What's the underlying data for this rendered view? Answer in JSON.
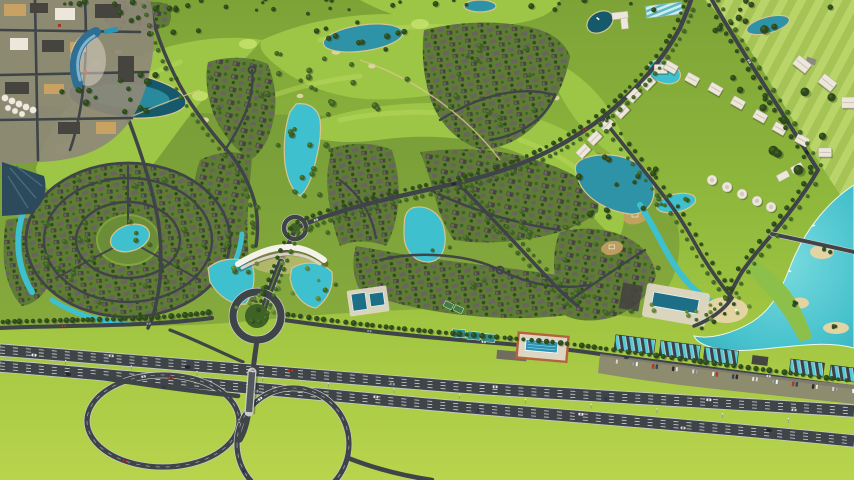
{
  "scene": {
    "type": "aerial-3d-masterplan-render",
    "description": "Bird's-eye 3D rendering of a golf-course residential master-planned community: golf fairways with lakes and sand bunkers, dense villa clusters along curved tree-lined streets, a circular villa village with a central lake, an entrance gateway with crescent water features, a hotel/town-centre district, diagonal rows of white apartment buildings, agricultural green fields, a crystal lagoon with sandy islands, a commercial strip with teal glass roofs, and a multi-lane highway with a cloverleaf interchange and roundabout in the foreground.",
    "width_px": 854,
    "height_px": 480,
    "visible_text": "none"
  },
  "labels": {
    "scene": "Aerial masterplan rendering of a golf community development",
    "terrain": "Grass terrain",
    "fields": "Agricultural fields with crop strips and scattered trees",
    "golf": "Golf course fairways with bunkers and greens",
    "lakes": "Lakes and ponds",
    "clusters": "Villa clusters with dark roofs along curved streets",
    "village": "Circular villa village with central lake and ring roads",
    "roads": "Community road network",
    "entrance": "Entrance gateway with white canopy and crescent pools",
    "hotel": "Hotel and town-centre district",
    "apartments": "Rows of white apartment buildings",
    "commercial": "Commercial strip with teal glass roofs and parking",
    "lagoon": "Crystal lagoon with sandy islands",
    "beach": "Beach club with lap pool and cabanas",
    "amenities": "Sports courts and swimming-pool complex",
    "highway": "Multi-lane highway with grass median",
    "interchange": "Cloverleaf interchange, overpass and roundabout",
    "vehicles": "Cars on roads and parking",
    "trees": "Trees and landscaping"
  },
  "palette": {
    "grassTop": "#7da337",
    "grassMid": "#92b93d",
    "grassBright": "#b5d24b",
    "communityTint": "#6b8d37",
    "field": "#a6c356",
    "fieldStrip": "#bcd76c",
    "fairway": "#9dc647",
    "fairwayStripe": "#bada5f",
    "golfGreen": "#c3e06a",
    "treeD": "#2d491d",
    "treeM": "#3f6326",
    "treeL": "#5c8430",
    "palmHi": "#7ba83e",
    "waterD": "#15596a",
    "waterM": "#2e93a6",
    "waterB": "#3fc0cf",
    "lagoonHi": "#7adde5",
    "waterEdge": "#d8c58f",
    "road": "#3f4448",
    "roadLight": "#c9ccc7",
    "lane": "#e9ebea",
    "sand": "#e3d4a4",
    "tan": "#c7a263",
    "parking": "#716c60",
    "roofD": "#46443f",
    "roofG": "#6a655c",
    "roofHi": "#8e887c",
    "clusterBg": "#5e7c33",
    "white": "#ece7da",
    "whiteShade": "#b9b1a0",
    "glass": "#2f6f94",
    "glassHi": "#7fb3cf",
    "tealRoof": "#55ccd4",
    "pool": "#2a95b5",
    "poolDark": "#1c6f86",
    "orange": "#b4643c",
    "deck": "#ddd6c3",
    "canopy": "#f4f1e8"
  }
}
